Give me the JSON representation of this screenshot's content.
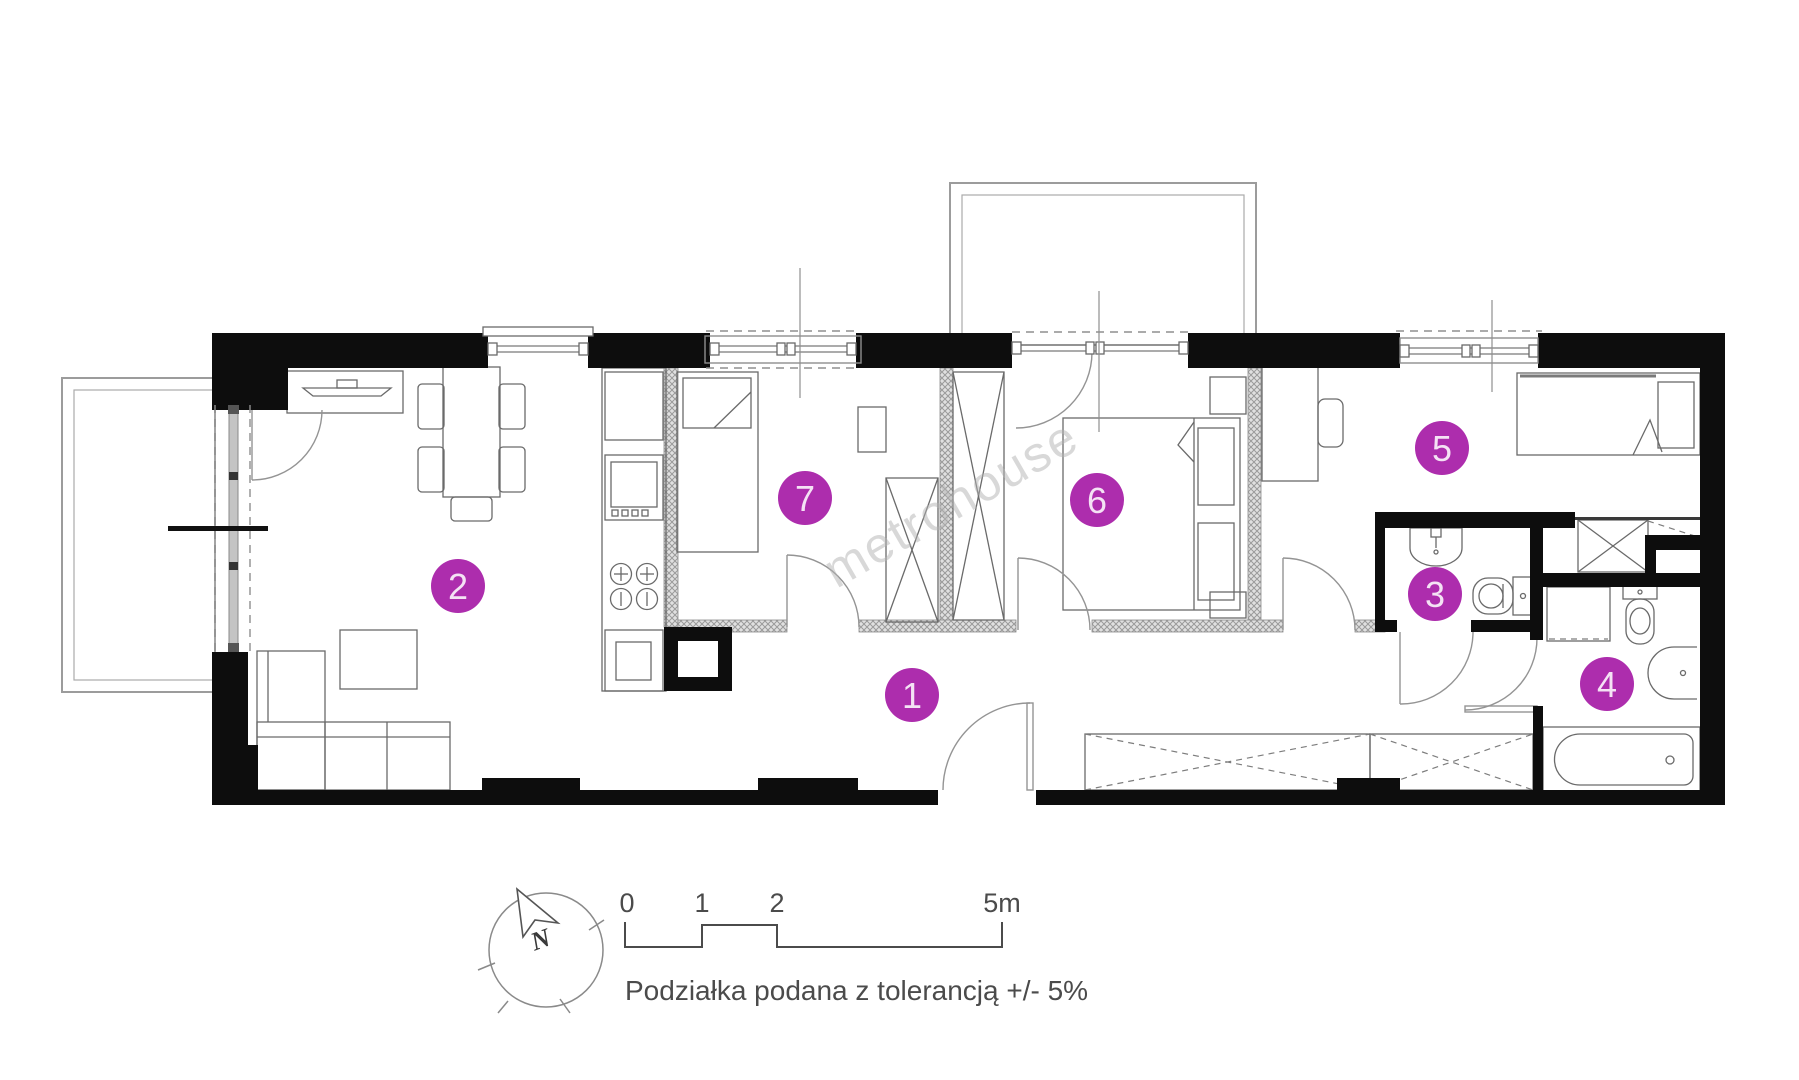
{
  "floorplan": {
    "watermark_text": "metrohouse",
    "compass": {
      "north_label": "N"
    },
    "scale_bar": {
      "tick_labels": [
        "0",
        "1",
        "2",
        "5m"
      ],
      "tolerance_note": "Podziałka podana z tolerancją +/- 5%"
    },
    "rooms": [
      {
        "number": "1"
      },
      {
        "number": "2"
      },
      {
        "number": "3"
      },
      {
        "number": "4"
      },
      {
        "number": "5"
      },
      {
        "number": "6"
      },
      {
        "number": "7"
      }
    ],
    "colors": {
      "badge_fill": "#ad2dad",
      "badge_text": "#f4e2f4",
      "wall": "#0d0d0d",
      "watermark": "#b3b3b3",
      "annotation": "#4b4b4b"
    }
  }
}
